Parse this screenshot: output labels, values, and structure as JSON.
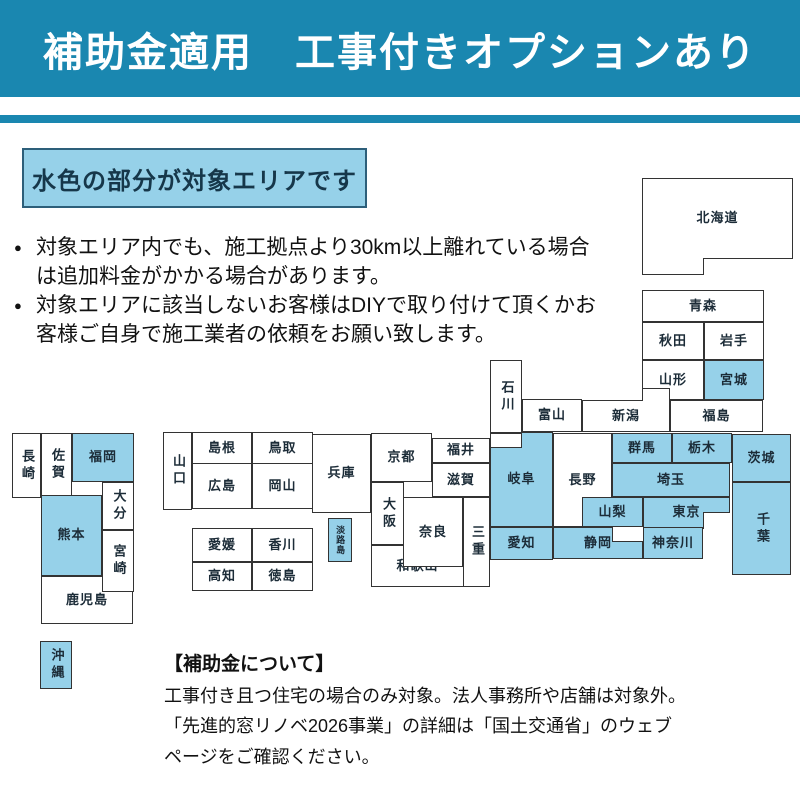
{
  "banner": {
    "title": "補助金適用　工事付きオプションあり"
  },
  "area_note": {
    "label": "水色の部分が対象エリアです"
  },
  "bullets": [
    [
      "対象エリア内でも、施工拠点より30km以上離れている場合",
      "は追加料金がかかる場合があります。"
    ],
    [
      "対象エリアに該当しないお客様はDIYで取り付けて頂くかお",
      "客様ご自身で施工業者の依頼をお願い致します。"
    ]
  ],
  "footer": {
    "heading": "【補助金について】",
    "lines": [
      "工事付き且つ住宅の場合のみ対象。法人事務所や店舗は対象外。",
      "「先進的窓リノベ2026事業」の詳細は「国土交通省」のウェブ",
      "ページをご確認ください。"
    ]
  },
  "colors": {
    "banner_bg": "#1a87b0",
    "highlight": "#96d1e9",
    "box_border": "#333333",
    "note_border": "#2d5f7a",
    "note_text": "#16374a"
  },
  "map": {
    "legend_meaning": "light-blue = covered area, white = not covered",
    "boxes": [
      {
        "id": "hokkaido",
        "label": "北海道",
        "x": 642,
        "y": 178,
        "w": 151,
        "h": 81,
        "f": "W",
        "o": "h"
      },
      {
        "id": "hokkaido-tab",
        "label": "",
        "x": 642,
        "y": 258,
        "w": 62,
        "h": 17,
        "f": "W",
        "o": "h",
        "borders": "lrb"
      },
      {
        "id": "aomori",
        "label": "青森",
        "x": 642,
        "y": 290,
        "w": 122,
        "h": 32,
        "f": "W",
        "o": "h"
      },
      {
        "id": "akita",
        "label": "秋田",
        "x": 642,
        "y": 322,
        "w": 62,
        "h": 38,
        "f": "W",
        "o": "h"
      },
      {
        "id": "iwate",
        "label": "岩手",
        "x": 704,
        "y": 322,
        "w": 60,
        "h": 38,
        "f": "W",
        "o": "h"
      },
      {
        "id": "yamagata",
        "label": "山形",
        "x": 642,
        "y": 360,
        "w": 62,
        "h": 40,
        "f": "W",
        "o": "h"
      },
      {
        "id": "miyagi",
        "label": "宮城",
        "x": 704,
        "y": 360,
        "w": 60,
        "h": 40,
        "f": "B",
        "o": "h"
      },
      {
        "id": "niigata",
        "label": "新潟",
        "x": 582,
        "y": 400,
        "w": 88,
        "h": 32,
        "f": "W",
        "o": "h"
      },
      {
        "id": "niigata-step",
        "label": "",
        "x": 642,
        "y": 388,
        "w": 28,
        "h": 13,
        "f": "W",
        "o": "h",
        "borders": "ltr"
      },
      {
        "id": "fukushima",
        "label": "福島",
        "x": 670,
        "y": 400,
        "w": 93,
        "h": 32,
        "f": "W",
        "o": "h"
      },
      {
        "id": "ishikawa",
        "label": "石川",
        "x": 490,
        "y": 360,
        "w": 32,
        "h": 73,
        "f": "W",
        "o": "v"
      },
      {
        "id": "toyama",
        "label": "富山",
        "x": 522,
        "y": 399,
        "w": 60,
        "h": 33,
        "f": "W",
        "o": "h"
      },
      {
        "id": "nagano",
        "label": "長野",
        "x": 553,
        "y": 433,
        "w": 59,
        "h": 94,
        "f": "W",
        "o": "h"
      },
      {
        "id": "gifu",
        "label": "岐阜",
        "x": 490,
        "y": 432,
        "w": 63,
        "h": 95,
        "f": "B",
        "o": "h"
      },
      {
        "id": "fukui-step",
        "label": "",
        "x": 490,
        "y": 433,
        "w": 32,
        "h": 15,
        "f": "W",
        "o": "h"
      },
      {
        "id": "gunma",
        "label": "群馬",
        "x": 612,
        "y": 433,
        "w": 60,
        "h": 30,
        "f": "B",
        "o": "h"
      },
      {
        "id": "tochigi",
        "label": "栃木",
        "x": 672,
        "y": 433,
        "w": 60,
        "h": 30,
        "f": "B",
        "o": "h"
      },
      {
        "id": "ibaraki",
        "label": "茨城",
        "x": 732,
        "y": 434,
        "w": 59,
        "h": 48,
        "f": "B",
        "o": "h"
      },
      {
        "id": "saitama",
        "label": "埼玉",
        "x": 612,
        "y": 463,
        "w": 118,
        "h": 34,
        "f": "B",
        "o": "h"
      },
      {
        "id": "yamanashi",
        "label": "山梨",
        "x": 582,
        "y": 497,
        "w": 61,
        "h": 30,
        "f": "B",
        "o": "h"
      },
      {
        "id": "tokyo",
        "label": "東京",
        "x": 643,
        "y": 497,
        "w": 87,
        "h": 31,
        "f": "B",
        "o": "h"
      },
      {
        "id": "tokyo-bay-notch",
        "label": "",
        "x": 703,
        "y": 512,
        "w": 27,
        "h": 17,
        "f": "W",
        "o": "h",
        "borders": "lt"
      },
      {
        "id": "kanagawa",
        "label": "神奈川",
        "x": 643,
        "y": 527,
        "w": 60,
        "h": 32,
        "f": "B",
        "o": "h"
      },
      {
        "id": "chiba",
        "label": "千葉",
        "x": 732,
        "y": 482,
        "w": 59,
        "h": 93,
        "f": "B",
        "o": "v"
      },
      {
        "id": "shizuoka",
        "label": "静岡",
        "x": 553,
        "y": 527,
        "w": 90,
        "h": 32,
        "f": "B",
        "o": "h"
      },
      {
        "id": "sagami-notch",
        "label": "",
        "x": 612,
        "y": 527,
        "w": 31,
        "h": 15,
        "f": "W",
        "o": "h",
        "borders": "lb"
      },
      {
        "id": "aichi",
        "label": "愛知",
        "x": 490,
        "y": 527,
        "w": 63,
        "h": 33,
        "f": "B",
        "o": "h"
      },
      {
        "id": "fukui",
        "label": "福井",
        "x": 432,
        "y": 438,
        "w": 58,
        "h": 25,
        "f": "W",
        "o": "h"
      },
      {
        "id": "shiga",
        "label": "滋賀",
        "x": 432,
        "y": 463,
        "w": 58,
        "h": 34,
        "f": "W",
        "o": "h"
      },
      {
        "id": "kyoto",
        "label": "京都",
        "x": 371,
        "y": 433,
        "w": 61,
        "h": 49,
        "f": "W",
        "o": "h"
      },
      {
        "id": "osaka",
        "label": "大阪",
        "x": 371,
        "y": 482,
        "w": 33,
        "h": 63,
        "f": "W",
        "o": "v"
      },
      {
        "id": "wakayama",
        "label": "和歌山",
        "x": 371,
        "y": 545,
        "w": 93,
        "h": 42,
        "f": "W",
        "o": "h"
      },
      {
        "id": "nara",
        "label": "奈良",
        "x": 403,
        "y": 497,
        "w": 60,
        "h": 70,
        "f": "W",
        "o": "h"
      },
      {
        "id": "mie",
        "label": "三重",
        "x": 463,
        "y": 497,
        "w": 27,
        "h": 90,
        "f": "W",
        "o": "v"
      },
      {
        "id": "hyogo",
        "label": "兵庫",
        "x": 312,
        "y": 434,
        "w": 59,
        "h": 79,
        "f": "W",
        "o": "h"
      },
      {
        "id": "awaji",
        "label": "淡路島",
        "x": 328,
        "y": 518,
        "w": 24,
        "h": 44,
        "f": "B",
        "o": "v",
        "fs": 9
      },
      {
        "id": "yamaguchi",
        "label": "山口",
        "x": 163,
        "y": 432,
        "w": 29,
        "h": 78,
        "f": "W",
        "o": "v"
      },
      {
        "id": "shimane",
        "label": "島根",
        "x": 192,
        "y": 432,
        "w": 60,
        "h": 32,
        "f": "W",
        "o": "h"
      },
      {
        "id": "tottori",
        "label": "鳥取",
        "x": 252,
        "y": 432,
        "w": 61,
        "h": 32,
        "f": "W",
        "o": "h"
      },
      {
        "id": "hiroshima",
        "label": "広島",
        "x": 192,
        "y": 463,
        "w": 60,
        "h": 46,
        "f": "W",
        "o": "h"
      },
      {
        "id": "okayama",
        "label": "岡山",
        "x": 252,
        "y": 463,
        "w": 61,
        "h": 46,
        "f": "W",
        "o": "h"
      },
      {
        "id": "ehime",
        "label": "愛媛",
        "x": 192,
        "y": 528,
        "w": 60,
        "h": 34,
        "f": "W",
        "o": "h"
      },
      {
        "id": "kagawa",
        "label": "香川",
        "x": 252,
        "y": 528,
        "w": 61,
        "h": 34,
        "f": "W",
        "o": "h"
      },
      {
        "id": "kochi",
        "label": "高知",
        "x": 192,
        "y": 562,
        "w": 60,
        "h": 29,
        "f": "W",
        "o": "h"
      },
      {
        "id": "tokushima",
        "label": "徳島",
        "x": 252,
        "y": 562,
        "w": 61,
        "h": 29,
        "f": "W",
        "o": "h"
      },
      {
        "id": "nagasaki",
        "label": "長崎",
        "x": 12,
        "y": 433,
        "w": 29,
        "h": 65,
        "f": "W",
        "o": "v"
      },
      {
        "id": "saga",
        "label": "佐賀",
        "x": 41,
        "y": 433,
        "w": 31,
        "h": 63,
        "f": "W",
        "o": "v"
      },
      {
        "id": "fukuoka",
        "label": "福岡",
        "x": 72,
        "y": 433,
        "w": 62,
        "h": 49,
        "f": "B",
        "o": "h"
      },
      {
        "id": "oita",
        "label": "大分",
        "x": 102,
        "y": 482,
        "w": 32,
        "h": 48,
        "f": "W",
        "o": "v"
      },
      {
        "id": "kumamoto",
        "label": "熊本",
        "x": 41,
        "y": 495,
        "w": 61,
        "h": 81,
        "f": "B",
        "o": "h"
      },
      {
        "id": "kagoshima",
        "label": "鹿児島",
        "x": 41,
        "y": 576,
        "w": 92,
        "h": 48,
        "f": "W",
        "o": "h"
      },
      {
        "id": "miyazaki",
        "label": "宮崎",
        "x": 102,
        "y": 530,
        "w": 32,
        "h": 62,
        "f": "W",
        "o": "v"
      },
      {
        "id": "okinawa",
        "label": "沖縄",
        "x": 40,
        "y": 641,
        "w": 32,
        "h": 48,
        "f": "B",
        "o": "v"
      }
    ]
  }
}
